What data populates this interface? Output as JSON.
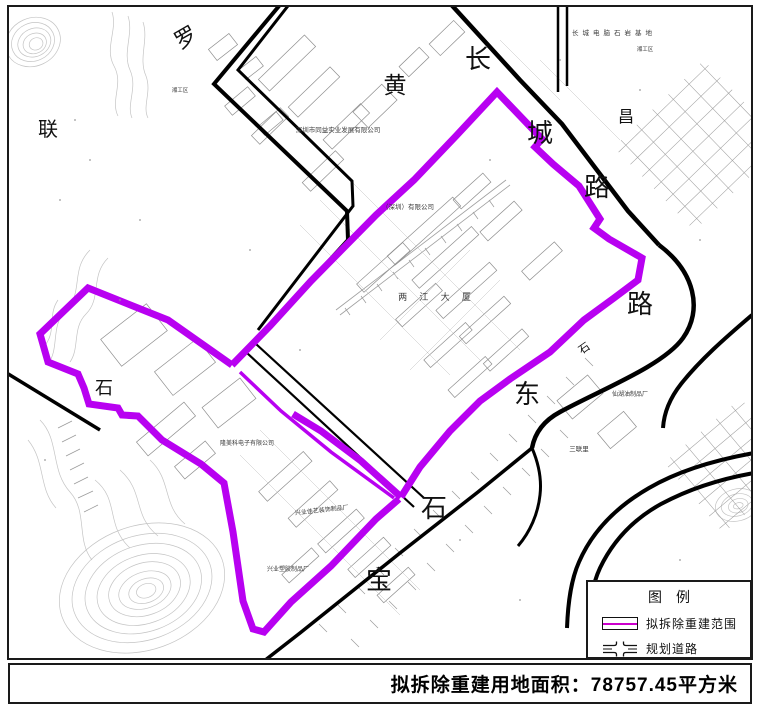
{
  "map": {
    "large_labels": [
      {
        "text": "罗"
      },
      {
        "text": "联"
      },
      {
        "text": "黄"
      },
      {
        "text": "长"
      },
      {
        "text": "城"
      },
      {
        "text": "路"
      },
      {
        "text": "昌"
      },
      {
        "text": "路"
      },
      {
        "text": "东"
      },
      {
        "text": "石"
      },
      {
        "text": "石"
      },
      {
        "text": "石"
      },
      {
        "text": "宝"
      }
    ],
    "small_labels": [
      {
        "text": "深圳市同益实业发展有限公司"
      },
      {
        "text": "（深圳）有限公司"
      },
      {
        "text": "两 江 大 厦"
      },
      {
        "text": "长城电脑石岩基地"
      },
      {
        "text": "隆美科电子有限公司"
      },
      {
        "text": "兴业佳艺装饰制品厂"
      },
      {
        "text": "兴业塑胶制品厂"
      },
      {
        "text": "仙湖油制品厂"
      },
      {
        "text": "三联里"
      },
      {
        "text": "湘工区"
      },
      {
        "text": "湘工区"
      }
    ]
  },
  "legend": {
    "title": "图　例",
    "items": [
      {
        "label": "拟拆除重建范围",
        "symbol": "demolition-boundary-symbol"
      },
      {
        "label": "规划道路",
        "symbol": "planned-road-symbol"
      }
    ]
  },
  "footer": {
    "label": "拟拆除重建用地面积：78757.45平方米"
  },
  "colors": {
    "boundary": "#B801F1",
    "legend_line": "#CC00CC",
    "road": "#000000"
  }
}
